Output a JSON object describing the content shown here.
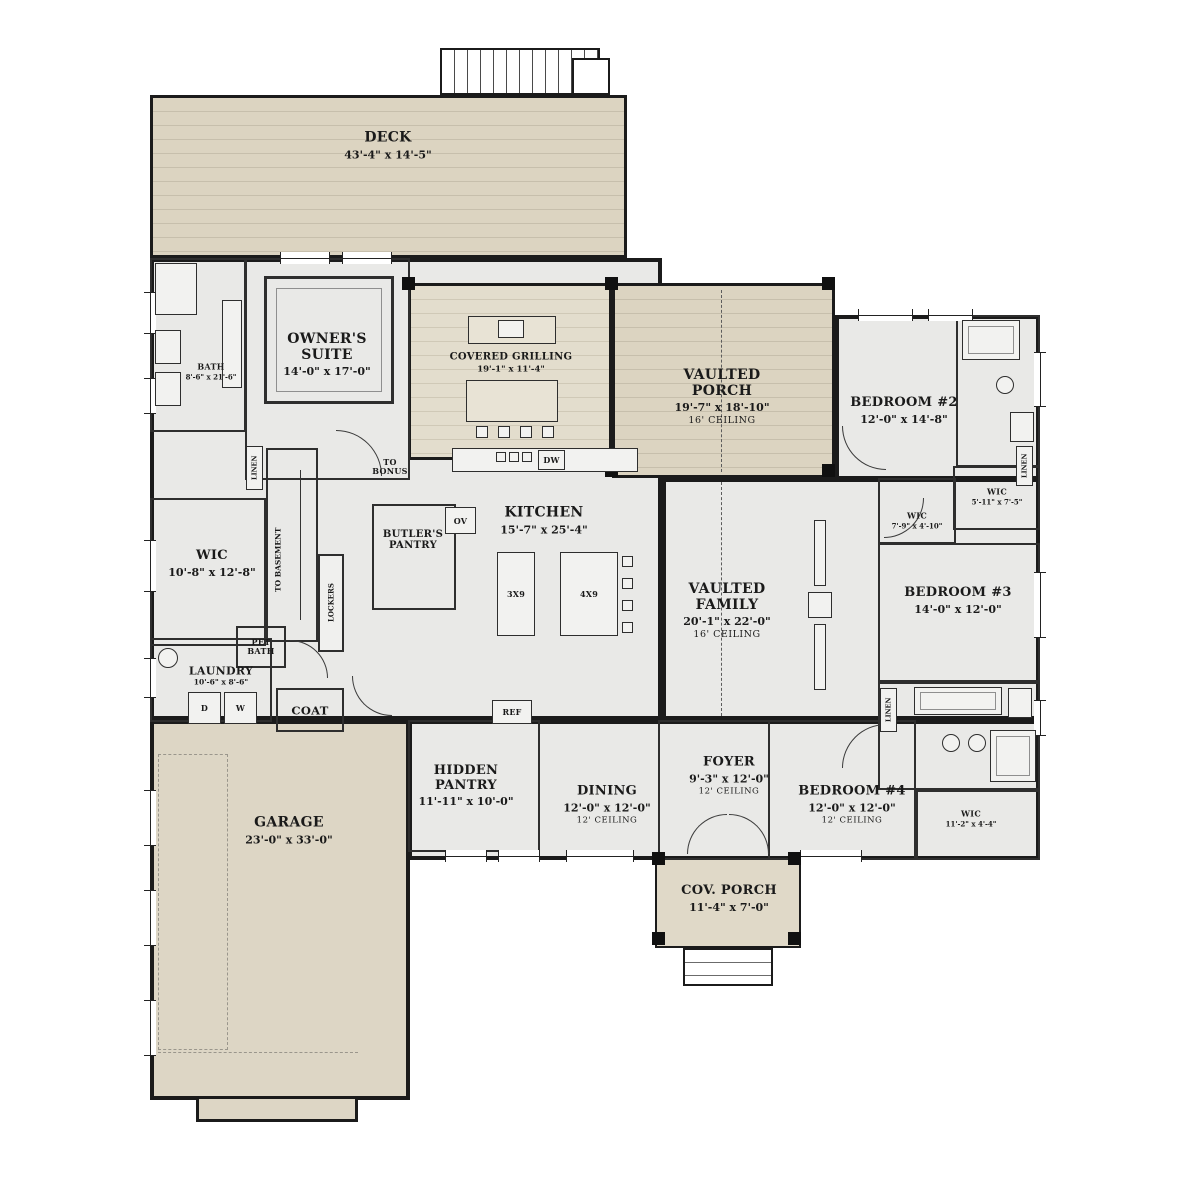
{
  "colors": {
    "wall": "#1b1b1b",
    "interior_fill": "#e9e9e7",
    "deck_fill": "#dcd4c1",
    "garage_fill": "#ddd6c5",
    "porch_fill": "#e0d9c8"
  },
  "rooms": [
    {
      "name": "DECK",
      "dims": "43'-4\" x 14'-5\""
    },
    {
      "name": "OWNER'S SUITE",
      "dims": "14'-0\" x 17'-0\""
    },
    {
      "name": "BATH",
      "dims": "8'-6\" x 21'-6\""
    },
    {
      "name": "COVERED GRILLING",
      "dims": "19'-1\" x 11'-4\""
    },
    {
      "name": "VAULTED PORCH",
      "dims": "19'-7\" x 18'-10\"",
      "ceiling": "16' CEILING"
    },
    {
      "name": "BEDROOM #2",
      "dims": "12'-0\" x 14'-8\""
    },
    {
      "name": "WIC",
      "dims": "5'-11\" x 7'-5\""
    },
    {
      "name": "WIC",
      "dims": "7'-9\" x 4'-10\""
    },
    {
      "name": "KITCHEN",
      "dims": "15'-7\" x 25'-4\""
    },
    {
      "name": "BUTLER'S PANTRY"
    },
    {
      "name": "WIC",
      "dims": "10'-8\" x 12'-8\""
    },
    {
      "name": "VAULTED FAMILY",
      "dims": "20'-1\" x 22'-0\"",
      "ceiling": "16' CEILING"
    },
    {
      "name": "BEDROOM #3",
      "dims": "14'-0\" x 12'-0\""
    },
    {
      "name": "PET BATH"
    },
    {
      "name": "LAUNDRY",
      "dims": "10'-6\" x 8'-6\""
    },
    {
      "name": "COAT"
    },
    {
      "name": "GARAGE",
      "dims": "23'-0\" x 33'-0\""
    },
    {
      "name": "HIDDEN PANTRY",
      "dims": "11'-11\" x 10'-0\""
    },
    {
      "name": "DINING",
      "dims": "12'-0\" x 12'-0\"",
      "ceiling": "12' CEILING"
    },
    {
      "name": "FOYER",
      "dims": "9'-3\" x 12'-0\"",
      "ceiling": "12' CEILING"
    },
    {
      "name": "BEDROOM #4",
      "dims": "12'-0\" x 12'-0\"",
      "ceiling": "12' CEILING"
    },
    {
      "name": "WIC",
      "dims": "11'-2\" x 4'-4\""
    },
    {
      "name": "COV. PORCH",
      "dims": "11'-4\" x 7'-0\""
    }
  ],
  "labels": {
    "to_bonus": "TO BONUS",
    "to_basement": "TO BASEMENT",
    "lockers": "LOCKERS",
    "linen": "LINEN",
    "oven": "OV",
    "dishwasher": "DW",
    "fridge": "REF",
    "dryer": "D",
    "washer": "W",
    "island_small": "3X9",
    "island_large": "4X9"
  }
}
